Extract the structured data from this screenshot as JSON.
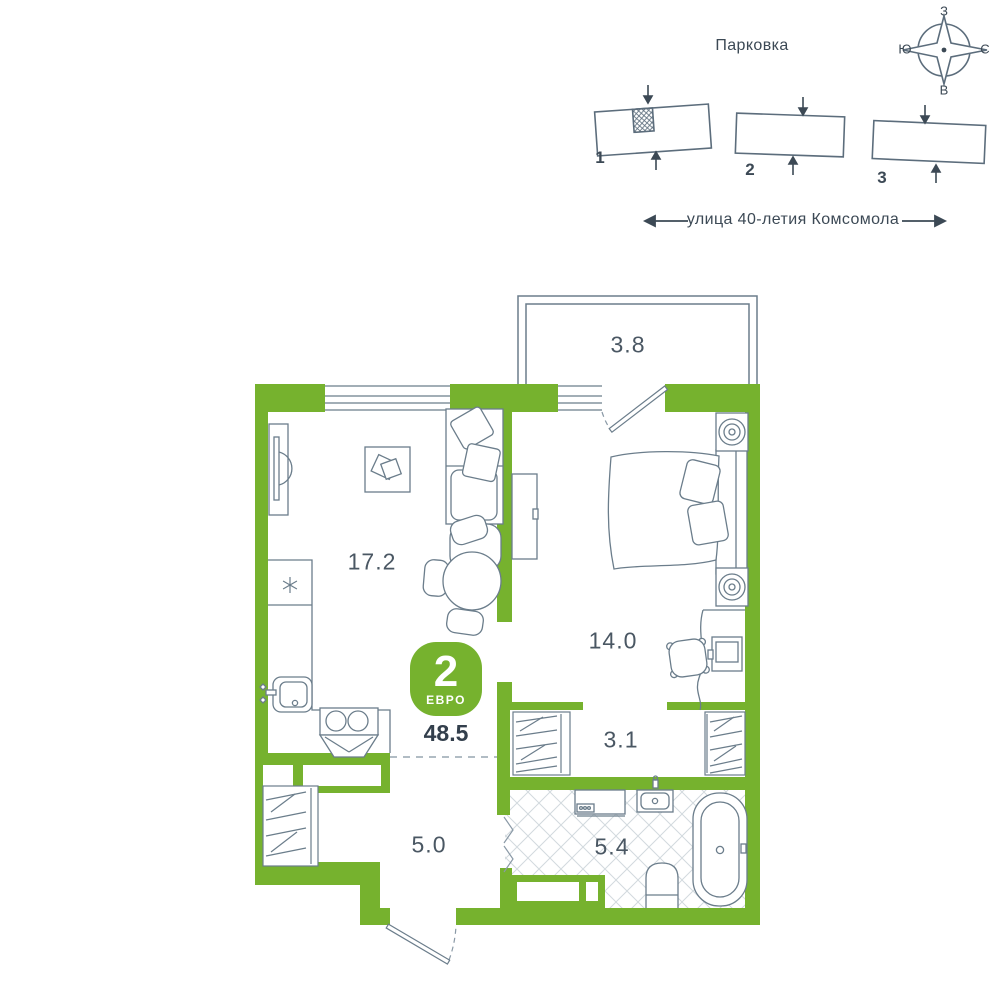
{
  "site_plan": {
    "parking_label": "Парковка",
    "street_label": "улица 40-летия Комсомола",
    "buildings": [
      {
        "number": "1",
        "highlighted": true
      },
      {
        "number": "2",
        "highlighted": false
      },
      {
        "number": "3",
        "highlighted": false
      }
    ],
    "compass": {
      "top": "З",
      "left": "Ю",
      "right": "С",
      "bottom": "В"
    }
  },
  "apartment": {
    "badge": {
      "rooms": "2",
      "type_label": "ЕВРО"
    },
    "total_area": "48.5",
    "areas": {
      "balcony": "3.8",
      "living_kitchen": "17.2",
      "bedroom": "14.0",
      "wardrobe": "3.1",
      "hallway": "5.0",
      "bathroom": "5.4"
    }
  },
  "icons": {
    "compass": "compass-rose",
    "fridge_symbol": "✳",
    "site_arrows": "entrance-arrows",
    "street_arrows": "left-right-arrows"
  },
  "colors": {
    "accent_green": "#76b22e",
    "outline": "#6b7d8b",
    "text_dark": "#3c4955",
    "tile_line": "#d2d9de"
  }
}
